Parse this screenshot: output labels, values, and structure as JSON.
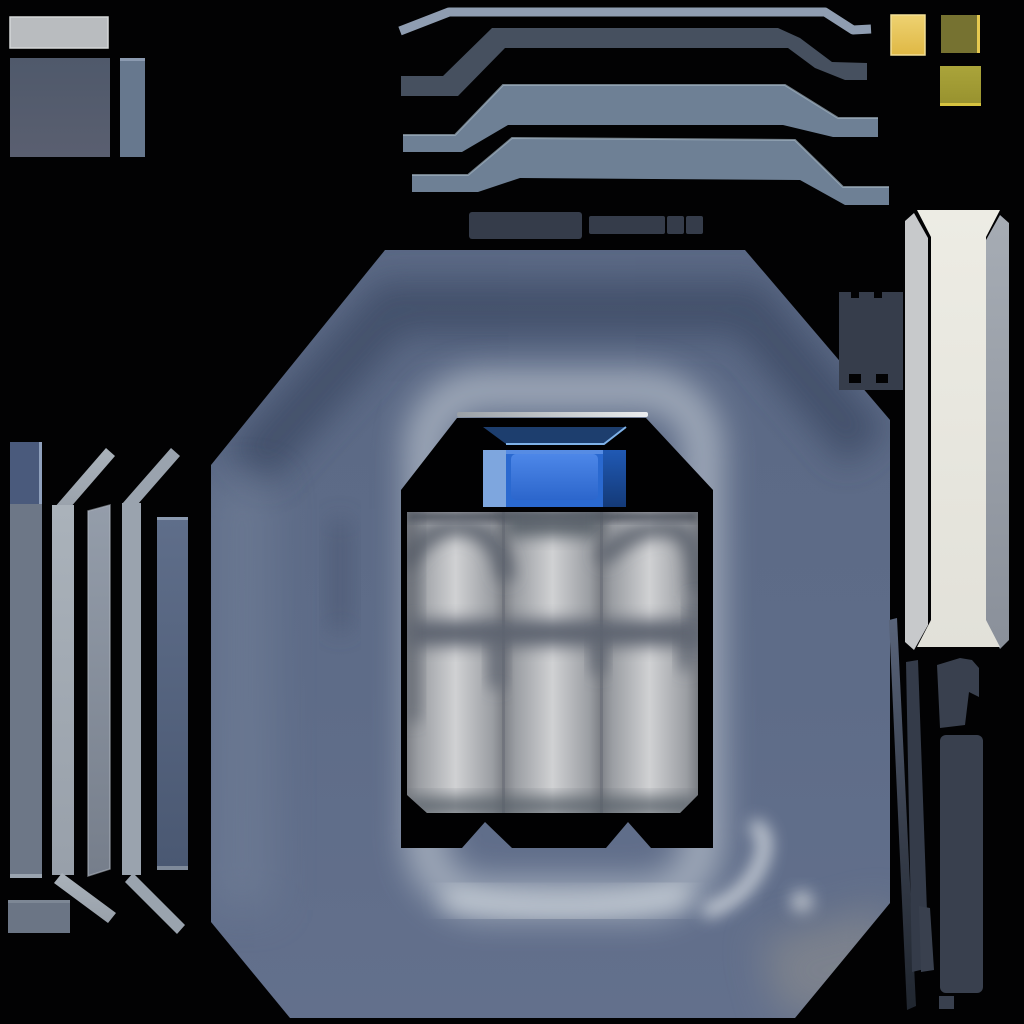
{
  "canvas": {
    "width": 1024,
    "height": 1024,
    "background": "#020203"
  },
  "palette": {
    "bg": "#020203",
    "octagonBase": "#5e6c88",
    "octagonDark": "#43506b",
    "ringLight": "#a7b1bf",
    "openingBlack": "#010102",
    "cylinderLight": "#d0d1d3",
    "cylinderShade": "#5d646f",
    "blueCell": "#2a69d0",
    "blueCellLight": "#7ea6de",
    "blueCellDark": "#16407f",
    "navyLid": "#1d3e6e",
    "thinStrip": "#8f9db1",
    "darkBand": "#46505f",
    "wideBand": "#6e8095",
    "connectorDark": "#353c4a",
    "yellowBright": "#e5c157",
    "yellowOlive": "#767231",
    "yellowDark": "#a49e39",
    "ivory": "#e9e8e0",
    "sideStripLight": "#c7c9cb",
    "sideStripGray": "#99a0a9",
    "ventBlock": "#363d4b",
    "railDark": "#39404e",
    "leftRailGray": "#6d7787",
    "leftRailTopBlue": "#4a5a7c",
    "leftRailSilver": "#a3abb4",
    "leftRailMid": "#8b94a0",
    "leftRailBlue": "#56658a",
    "plateLight": "#b9bcbf",
    "plateDark": "#535d6e",
    "plateBar": "#67788e",
    "silverLine": "#e8eaec"
  },
  "atlas": {
    "parts": [
      {
        "name": "light-gray-plate",
        "region": "top-left",
        "color": "#b9bcbf"
      },
      {
        "name": "dark-panel-square",
        "region": "top-left",
        "color": "#535d6e"
      },
      {
        "name": "narrow-panel-bar",
        "region": "top-left",
        "color": "#67788e"
      },
      {
        "name": "thin-trim-strip",
        "region": "top",
        "color": "#8f9db1"
      },
      {
        "name": "dark-trim-band",
        "region": "top",
        "color": "#46505f"
      },
      {
        "name": "wide-trim-band-upper",
        "region": "top",
        "color": "#6e8095"
      },
      {
        "name": "wide-trim-band-lower",
        "region": "top",
        "color": "#6e8095"
      },
      {
        "name": "connector-blocks",
        "region": "upper-middle",
        "color": "#353c4a",
        "count": 4
      },
      {
        "name": "yellow-cap-bright",
        "region": "top-right",
        "color": "#e5c157"
      },
      {
        "name": "yellow-cap-olive",
        "region": "top-right",
        "color": "#767231"
      },
      {
        "name": "yellow-cap-dark",
        "region": "top-right",
        "color": "#a49e39"
      },
      {
        "name": "octagon-hatch-panel",
        "region": "center",
        "color": "#5e6c88"
      },
      {
        "name": "hatch-opening",
        "region": "center",
        "color": "#010102"
      },
      {
        "name": "battery-cylinders",
        "region": "center",
        "color": "#d0d1d3",
        "count": 3
      },
      {
        "name": "blue-power-cell",
        "region": "center",
        "color": "#2a69d0"
      },
      {
        "name": "blue-cell-lid",
        "region": "center",
        "color": "#1d3e6e"
      },
      {
        "name": "ivory-column",
        "region": "right",
        "color": "#e9e8e0"
      },
      {
        "name": "column-side-strip-left",
        "region": "right",
        "color": "#c7c9cb"
      },
      {
        "name": "column-side-strip-right",
        "region": "right",
        "color": "#99a0a9"
      },
      {
        "name": "vent-block",
        "region": "right",
        "color": "#363d4b"
      },
      {
        "name": "diagonal-rail",
        "region": "bottom-right",
        "color": "#39404e"
      },
      {
        "name": "vertical-rails",
        "region": "bottom-right",
        "color": "#39404e",
        "count": 4
      },
      {
        "name": "edge-rail-gray",
        "region": "left",
        "color": "#6d7787"
      },
      {
        "name": "edge-rail-bent-silver",
        "region": "left",
        "color": "#a3abb4"
      },
      {
        "name": "edge-rail-mid",
        "region": "left",
        "color": "#8b94a0"
      },
      {
        "name": "edge-rail-bent-light",
        "region": "left",
        "color": "#9aa3ae"
      },
      {
        "name": "edge-rail-blue",
        "region": "left",
        "color": "#56658a"
      },
      {
        "name": "small-gray-block",
        "region": "bottom-left",
        "color": "#6b7585"
      }
    ]
  }
}
